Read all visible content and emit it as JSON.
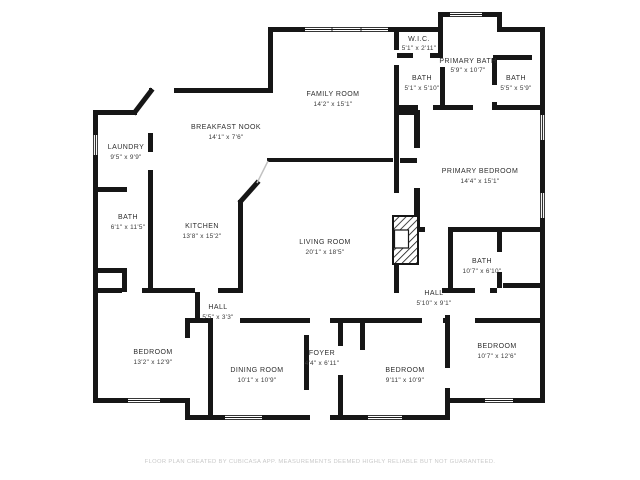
{
  "colors": {
    "background": "#ffffff",
    "wall": "#161616",
    "label": "#2e2e2e",
    "dims": "#3a3a3a",
    "divider": "#c2c2c2",
    "footer": "#c9c9c9"
  },
  "rooms": {
    "laundry": {
      "name": "LAUNDRY",
      "dims": "9'5\" x 9'9\""
    },
    "bath_left": {
      "name": "BATH",
      "dims": "6'1\" x 11'5\""
    },
    "kitchen": {
      "name": "KITCHEN",
      "dims": "13'8\" x 15'2\""
    },
    "breakfast_nook": {
      "name": "BREAKFAST NOOK",
      "dims": "14'1\" x 7'6\""
    },
    "family_room": {
      "name": "FAMILY ROOM",
      "dims": "14'2\" x 15'1\""
    },
    "wic": {
      "name": "W.I.C.",
      "dims": "5'1\" x 2'11\""
    },
    "primary_bath": {
      "name": "PRIMARY BATH",
      "dims": "5'9\" x 10'7\""
    },
    "bath_top_left": {
      "name": "BATH",
      "dims": "5'1\" x 5'10\""
    },
    "bath_top_right": {
      "name": "BATH",
      "dims": "5'5\" x 5'9\""
    },
    "primary_bedroom": {
      "name": "PRIMARY BEDROOM",
      "dims": "14'4\" x 15'1\""
    },
    "living_room": {
      "name": "LIVING ROOM",
      "dims": "20'1\" x 18'5\""
    },
    "bath_right": {
      "name": "BATH",
      "dims": "10'7\" x 6'10\""
    },
    "hall_right": {
      "name": "HALL",
      "dims": "5'10\" x 9'1\""
    },
    "hall_center": {
      "name": "HALL",
      "dims": "5'5\" x 3'3\""
    },
    "bedroom_bottom_left": {
      "name": "BEDROOM",
      "dims": "13'2\" x 12'9\""
    },
    "dining_room": {
      "name": "DINING ROOM",
      "dims": "10'1\" x 10'9\""
    },
    "foyer": {
      "name": "FOYER",
      "dims": "4'4\" x 6'11\""
    },
    "bedroom_bottom_center": {
      "name": "BEDROOM",
      "dims": "9'11\" x 10'9\""
    },
    "bedroom_bottom_right": {
      "name": "BEDROOM",
      "dims": "10'7\" x 12'6\""
    }
  },
  "footer": {
    "disclaimer": "FLOOR PLAN CREATED BY CUBICASA APP. MEASUREMENTS DEEMED HIGHLY RELIABLE BUT NOT GUARANTEED."
  }
}
